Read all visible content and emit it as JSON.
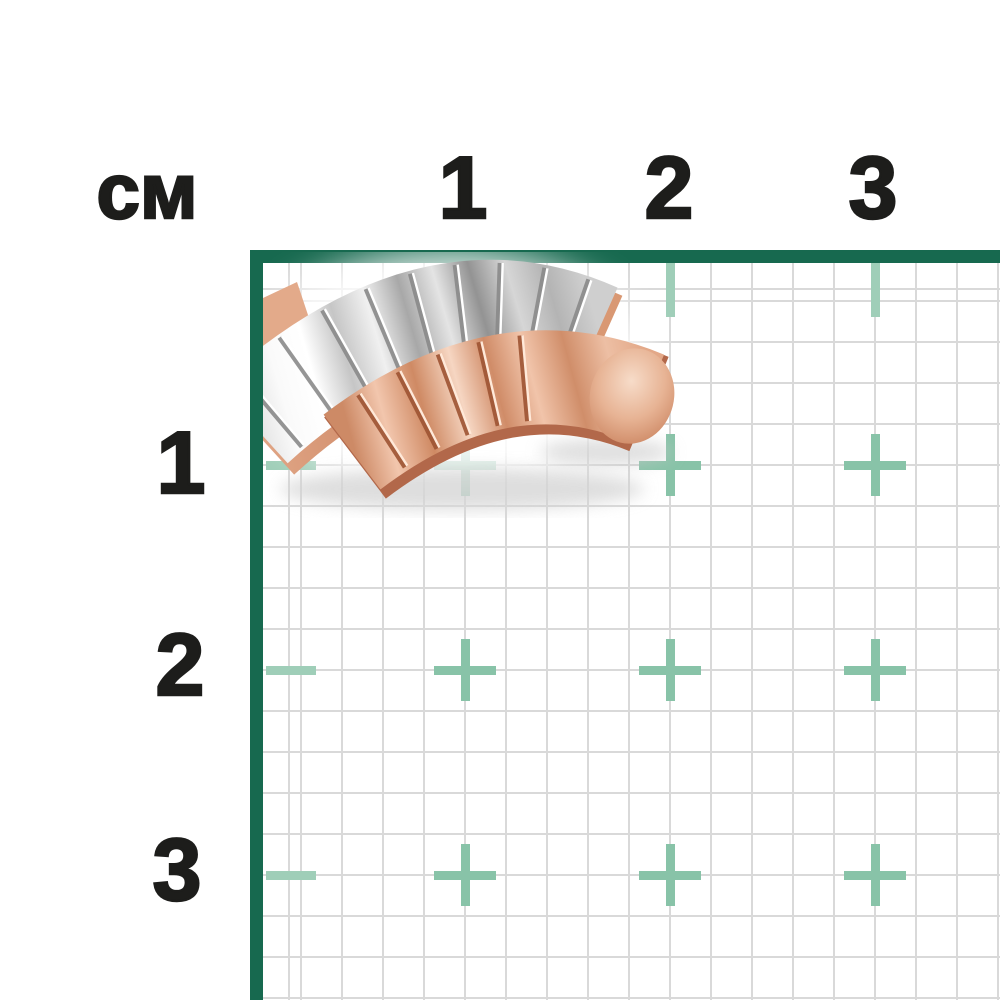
{
  "ruler": {
    "unit_label": "см",
    "top_axis_labels": [
      "1",
      "2",
      "3"
    ],
    "left_axis_labels": [
      "1",
      "2",
      "3"
    ],
    "pixels_per_cm": 205,
    "minor_squares_per_cm": 5,
    "colors": {
      "border_green": "#17694f",
      "tick_teal": "#9fceb8",
      "plus_teal": "#88c3a8",
      "grid_line_gray": "#d9d9d9",
      "label_black": "#1d1d1b",
      "background": "#ffffff"
    }
  },
  "photo": {
    "subject": "two-tone ribbed crossover ring",
    "colors": {
      "upper_band_silver": "#e8e8e8",
      "upper_band_shadow": "#9a9a9a",
      "lower_band_rose_gold": "#e2a380",
      "rose_deep": "#b2684a",
      "rose_rim": "#d4926f",
      "groove_highlight_silver": "#ffffff",
      "groove_highlight_rose": "#ffe9d9"
    }
  }
}
